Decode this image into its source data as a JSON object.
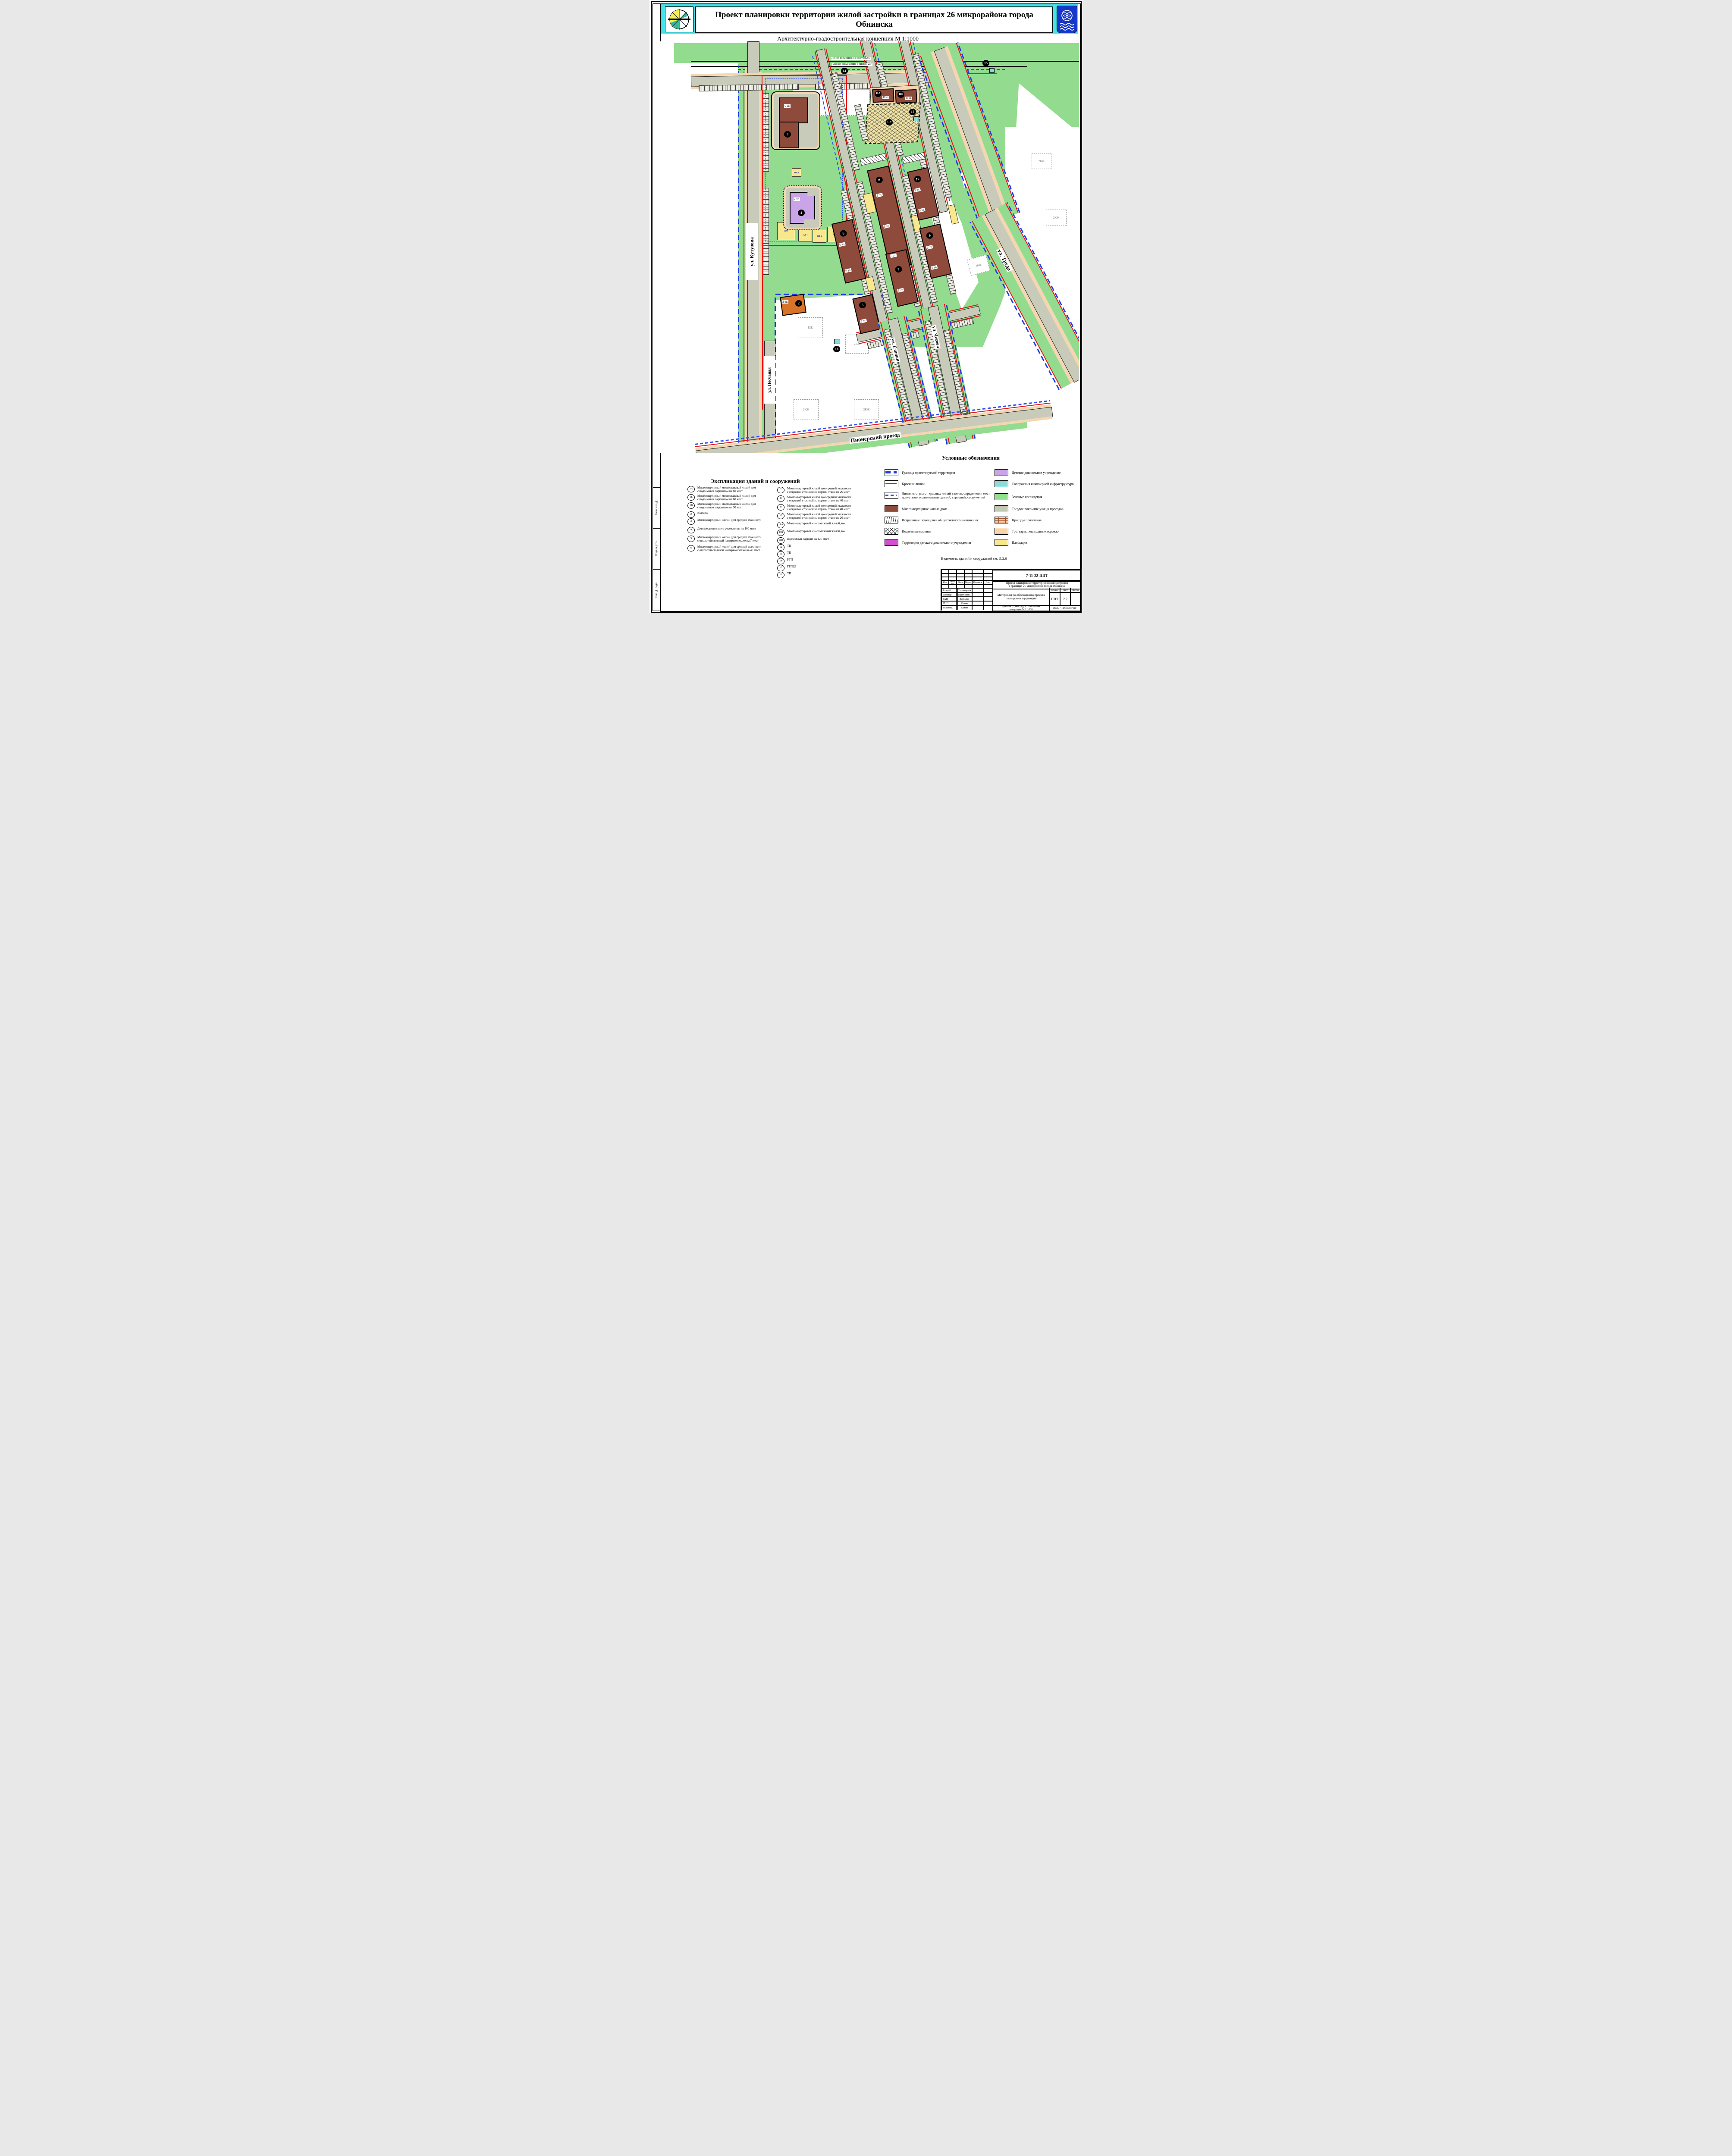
{
  "header": {
    "title": "Проект планировки территории жилой застройки в границах 26 микрорайона города Обнинска",
    "subtitle": "Архитектурно-градостроительная концепция М 1:1000"
  },
  "map": {
    "alignment_line_1": "Линия совмещения с листом 2.6",
    "alignment_line_2": "Линия совмещения с листом 2.7",
    "streets": {
      "kutuzova": "ул. Кутузова",
      "truda": "ул. Труда",
      "peschanaya": "ул. Песчаная",
      "glinki": "ул. Глинки",
      "chekhova": "ул. Чехова",
      "pionersky": "Пионерский проезд"
    },
    "floor_labels": {
      "f2": "2 эт.",
      "f3": "3 эт.",
      "f5": "5 эт.",
      "f19": "19 эт."
    },
    "existing": {
      "kzh": "КЖ",
      "kzh2": "2КЖ",
      "kzh3": "3КЖ",
      "kzh21": "21КЖ"
    },
    "pad_labels": {
      "pf": "ПФ",
      "pd1": "ПД-1",
      "pd2": "ПД-2",
      "pd3": "ПД-3",
      "pd4": "ПД-4"
    },
    "markers": {
      "m2": "2",
      "m3": "3",
      "m4": "4",
      "m5": "5",
      "m6": "6",
      "m7": "7",
      "m8": "8",
      "m9": "9",
      "m10": "10",
      "m11a": "11А",
      "m11b": "11Б",
      "m11v": "11В",
      "m12": "12",
      "m14": "14",
      "m15": "15",
      "m16": "16"
    }
  },
  "legend": {
    "title": "Условные обозначения",
    "left": [
      {
        "label": "Граница проектируемой территории"
      },
      {
        "label": "Красные линии"
      },
      {
        "label": "Линии отступа от красных линий в целях определения мест\nдопустимого размещения зданий, строений, сооружений"
      },
      {
        "label": "Многоквартирные жилые дома"
      },
      {
        "label": "Встроенные помещения общественного назначения"
      },
      {
        "label": "Подземные паркинг"
      },
      {
        "label": "Территория детского дошкольного учреждения"
      }
    ],
    "right": [
      {
        "color": "#c9a4e8",
        "label": "Детское дошкольное учреждение"
      },
      {
        "color": "#8fd9d9",
        "label": "Сооружения инженерной инфраструктуры"
      },
      {
        "color": "#90e08c",
        "label": "Зеленые насаждения"
      },
      {
        "color": "#c5c8b4",
        "label": "Твердое покрытие улиц и проездов"
      },
      {
        "color": "brick",
        "label": "Проезды плиточные"
      },
      {
        "color": "#f6d5ae",
        "label": "Тротуары, пешеходные дорожки"
      },
      {
        "color": "#f9e78e",
        "label": "Площадки"
      }
    ]
  },
  "explication": {
    "title": "Экспликация зданий и сооружений",
    "left": [
      {
        "num": "1А",
        "text": "Многоквартирный многоэтажный жилой дом\nс подземным паркингом на 60 мест"
      },
      {
        "num": "1Б",
        "text": "Многоквартирный многоэтажный жилой дом\nс подземным паркингом на 60 мест"
      },
      {
        "num": "1В",
        "text": "Многоквартирный многоэтажный жилой дом\nс подземным паркингом на 30 мест"
      },
      {
        "num": "2",
        "text": "Коттедж"
      },
      {
        "num": "3",
        "text": "Многоквартирный  жилой дом средней этажности"
      },
      {
        "num": "4",
        "text": "Детское дошкольное учреждение на 100 мест"
      },
      {
        "num": "5",
        "text": "Многоквартирный  жилой дом средней этажности\nс открытой стоянкой на первом этаже на 7 мест"
      },
      {
        "num": "6",
        "text": "Многоквартирный  жилой дом средней этажности\nс открытой стоянкой на первом этаже на 40 мест"
      }
    ],
    "right": [
      {
        "num": "7",
        "text": "Многоквартирный  жилой дом средней этажности\nс открытой стоянкой на первом этаже на 26 мест"
      },
      {
        "num": "8",
        "text": "Многоквартирный  жилой дом средней этажности\nс открытой стоянкой на первом этаже на 40 мест"
      },
      {
        "num": "9",
        "text": "Многоквартирный  жилой дом средней этажности\nс открытой стоянкой на первом этаже на 40 мест"
      },
      {
        "num": "10",
        "text": "Многоквартирный  жилой дом средней этажности\nс открытой стоянкой на первом этаже на 26 мест"
      },
      {
        "num": "11А",
        "text": "Многоквартирный многоэтажный жилой дом"
      },
      {
        "num": "11Б",
        "text": "Многоквартирный многоэтажный жилой дом"
      },
      {
        "num": "11В",
        "text": "Подземный паркинг на 125 мест"
      },
      {
        "num": "12",
        "text": "ТП"
      },
      {
        "num": "13",
        "text": "ТП"
      },
      {
        "num": "14",
        "text": "РТП"
      },
      {
        "num": "15",
        "text": "ГРПШ"
      },
      {
        "num": "16",
        "text": "ТП"
      }
    ]
  },
  "note": "Ведомость зданий и сооружений см. Л.2.6",
  "stamp": {
    "doc_number": "7-11-22-ППТ",
    "project": "Проект планировки территории жилой застройки\nв границах 26 микрорайона города Обнинска",
    "columns": [
      "Изм.",
      "Кол. уч.",
      "Лист",
      "№док.",
      "Подпись",
      "Дата"
    ],
    "roles": [
      {
        "role": "Разраб.",
        "name": "Столицына"
      },
      {
        "role": "Провер.",
        "name": "Шитикова"
      },
      {
        "role": "ГАП",
        "name": "Зайцева"
      },
      {
        "role": "ГИП",
        "name": "Котов"
      },
      {
        "role": "Н.контр.",
        "name": "Котов"
      }
    ],
    "section": "Материалы по обоснованию проекта\nпланировки территории",
    "stage_label": "Стадия",
    "sheet_label": "Лист",
    "sheets_label": "Листов",
    "stage": "ППТ",
    "sheet": "2.7",
    "sheets": "",
    "subtitle": "Архитектурно-градостроительная\nконцепция М 1:1000",
    "company": "ООО \"Технология\""
  },
  "side": {
    "s1": "Взам. инв.№",
    "s2": "Подп. и дата",
    "s3": "Инв.№ подл."
  }
}
